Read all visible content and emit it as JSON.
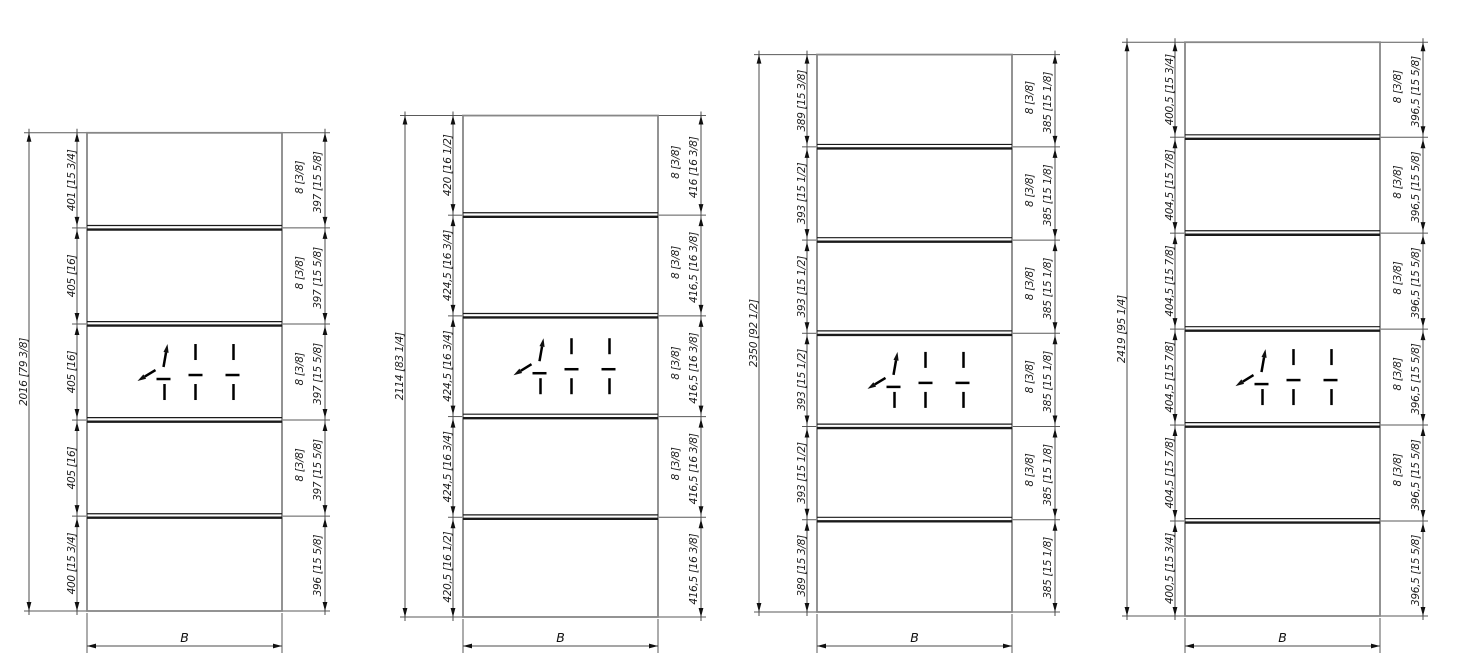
{
  "sheet": {
    "background_color": "#ffffff",
    "line_color": "#4b4b4b",
    "rail_color": "#1a1a1a",
    "text_color": "#1c1c1c"
  },
  "drawings": [
    {
      "name": "panel-1",
      "total_label": "2016 [79 3/8]",
      "left_labels": [
        "401 [15 3/4]",
        "405 [16]",
        "405 [16]",
        "405 [16]",
        "400 [15 3/4]"
      ],
      "rail_thickness_label": "8 [3/8]",
      "right_labels": [
        "397 [15 5/8]",
        "397 [15 5/8]",
        "397 [15 5/8]",
        "397 [15 5/8]",
        "396 [15 5/8]"
      ],
      "width_label": "B",
      "symbol_opening": 2
    },
    {
      "name": "panel-2",
      "total_label": "2114 [83 1/4]",
      "left_labels": [
        "420 [16 1/2]",
        "424,5 [16 3/4]",
        "424,5 [16 3/4]",
        "424,5 [16 3/4]",
        "420,5 [16 1/2]"
      ],
      "rail_thickness_label": "8 [3/8]",
      "right_labels": [
        "416 [16 3/8]",
        "416,5 [16 3/8]",
        "416,5 [16 3/8]",
        "416,5 [16 3/8]",
        "416,5 [16 3/8]"
      ],
      "width_label": "B",
      "symbol_opening": 2
    },
    {
      "name": "panel-3",
      "total_label": "2350 [92 1/2]",
      "left_labels": [
        "389 [15 3/8]",
        "393 [15 1/2]",
        "393 [15 1/2]",
        "393 [15 1/2]",
        "393 [15 1/2]",
        "389 [15 3/8]"
      ],
      "rail_thickness_label": "8 [3/8]",
      "right_labels": [
        "385 [15 1/8]",
        "385 [15 1/8]",
        "385 [15 1/8]",
        "385 [15 1/8]",
        "385 [15 1/8]",
        "385 [15 1/8]"
      ],
      "width_label": "B",
      "symbol_opening": 3
    },
    {
      "name": "panel-4",
      "total_label": "2419 [95 1/4]",
      "left_labels": [
        "400,5 [15 3/4]",
        "404,5 [15 7/8]",
        "404,5 [15 7/8]",
        "404,5 [15 7/8]",
        "404,5 [15 7/8]",
        "400,5 [15 3/4]"
      ],
      "rail_thickness_label": "8 [3/8]",
      "right_labels": [
        "396,5 [15 5/8]",
        "396,5 [15 5/8]",
        "396,5 [15 5/8]",
        "396,5 [15 5/8]",
        "396,5 [15 5/8]",
        "396,5 [15 5/8]"
      ],
      "width_label": "B",
      "symbol_opening": 3
    }
  ]
}
